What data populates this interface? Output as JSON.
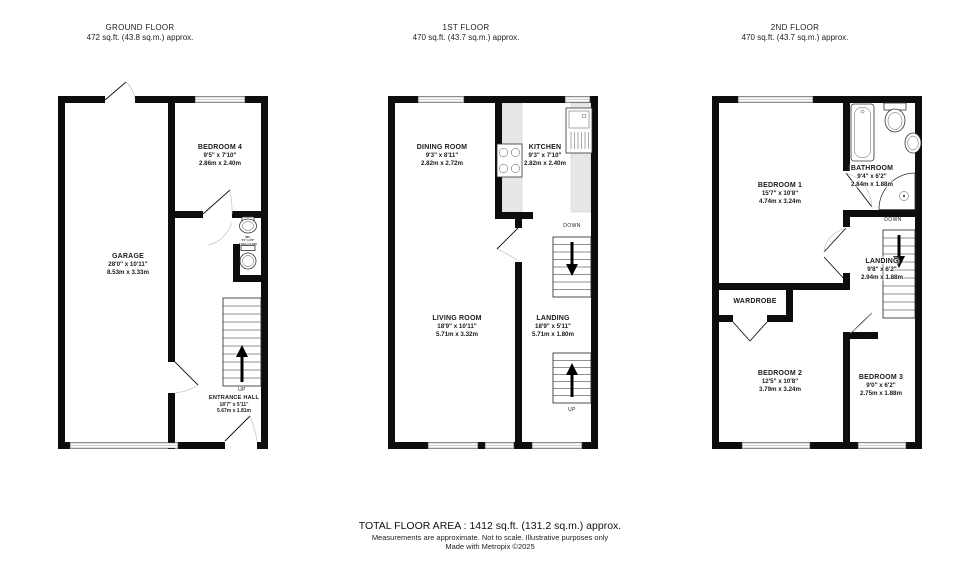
{
  "floors": [
    {
      "title": "GROUND FLOOR",
      "area": "472 sq.ft. (43.8 sq.m.) approx.",
      "rooms": {
        "bedroom4": {
          "name": "BEDROOM 4",
          "imperial": "9'5\" x 7'10\"",
          "metric": "2.86m x 2.40m"
        },
        "garage": {
          "name": "GARAGE",
          "imperial": "28'0\" x 10'11\"",
          "metric": "8.53m x 3.33m"
        },
        "entrance_hall": {
          "name": "ENTRANCE HALL",
          "imperial": "18'7\" x 5'11\"",
          "metric": "5.67m x 1.81m"
        },
        "wc": {
          "name": "WC",
          "imperial": "5'1\" x 2'6\"",
          "metric": "1.54m x 0.76m"
        }
      },
      "stairs": {
        "up": "UP"
      }
    },
    {
      "title": "1ST FLOOR",
      "area": "470 sq.ft. (43.7 sq.m.) approx.",
      "rooms": {
        "dining": {
          "name": "DINING ROOM",
          "imperial": "9'3\" x 8'11\"",
          "metric": "2.82m x 2.72m"
        },
        "kitchen": {
          "name": "KITCHEN",
          "imperial": "9'3\" x 7'10\"",
          "metric": "2.82m x 2.40m"
        },
        "living": {
          "name": "LIVING ROOM",
          "imperial": "18'9\" x 10'11\"",
          "metric": "5.71m x 3.32m"
        },
        "landing": {
          "name": "LANDING",
          "imperial": "18'9\" x 5'11\"",
          "metric": "5.71m x 1.80m"
        }
      },
      "stairs": {
        "up": "UP",
        "down": "DOWN"
      }
    },
    {
      "title": "2ND FLOOR",
      "area": "470 sq.ft. (43.7 sq.m.) approx.",
      "rooms": {
        "bedroom1": {
          "name": "BEDROOM 1",
          "imperial": "15'7\" x 10'8\"",
          "metric": "4.74m x 3.24m"
        },
        "bathroom": {
          "name": "BATHROOM",
          "imperial": "9'4\" x 6'2\"",
          "metric": "2.84m x 1.88m"
        },
        "landing": {
          "name": "LANDING",
          "imperial": "9'8\" x 6'2\"",
          "metric": "2.94m x 1.88m"
        },
        "wardrobe": {
          "name": "WARDROBE"
        },
        "bedroom2": {
          "name": "BEDROOM 2",
          "imperial": "12'5\" x 10'8\"",
          "metric": "3.79m x 3.24m"
        },
        "bedroom3": {
          "name": "BEDROOM 3",
          "imperial": "9'0\" x 6'2\"",
          "metric": "2.75m x 1.88m"
        }
      },
      "stairs": {
        "down": "DOWN"
      }
    }
  ],
  "footer": {
    "total": "TOTAL FLOOR AREA : 1412 sq.ft. (131.2 sq.m.) approx.",
    "disclaimer": "Measurements are approximate.  Not to scale.  Illustrative purposes only",
    "credit": "Made with Metropix ©2025"
  },
  "colors": {
    "wall": "#0d0d0d",
    "counter": "#e7e7e7",
    "text": "#1a1a1a"
  }
}
